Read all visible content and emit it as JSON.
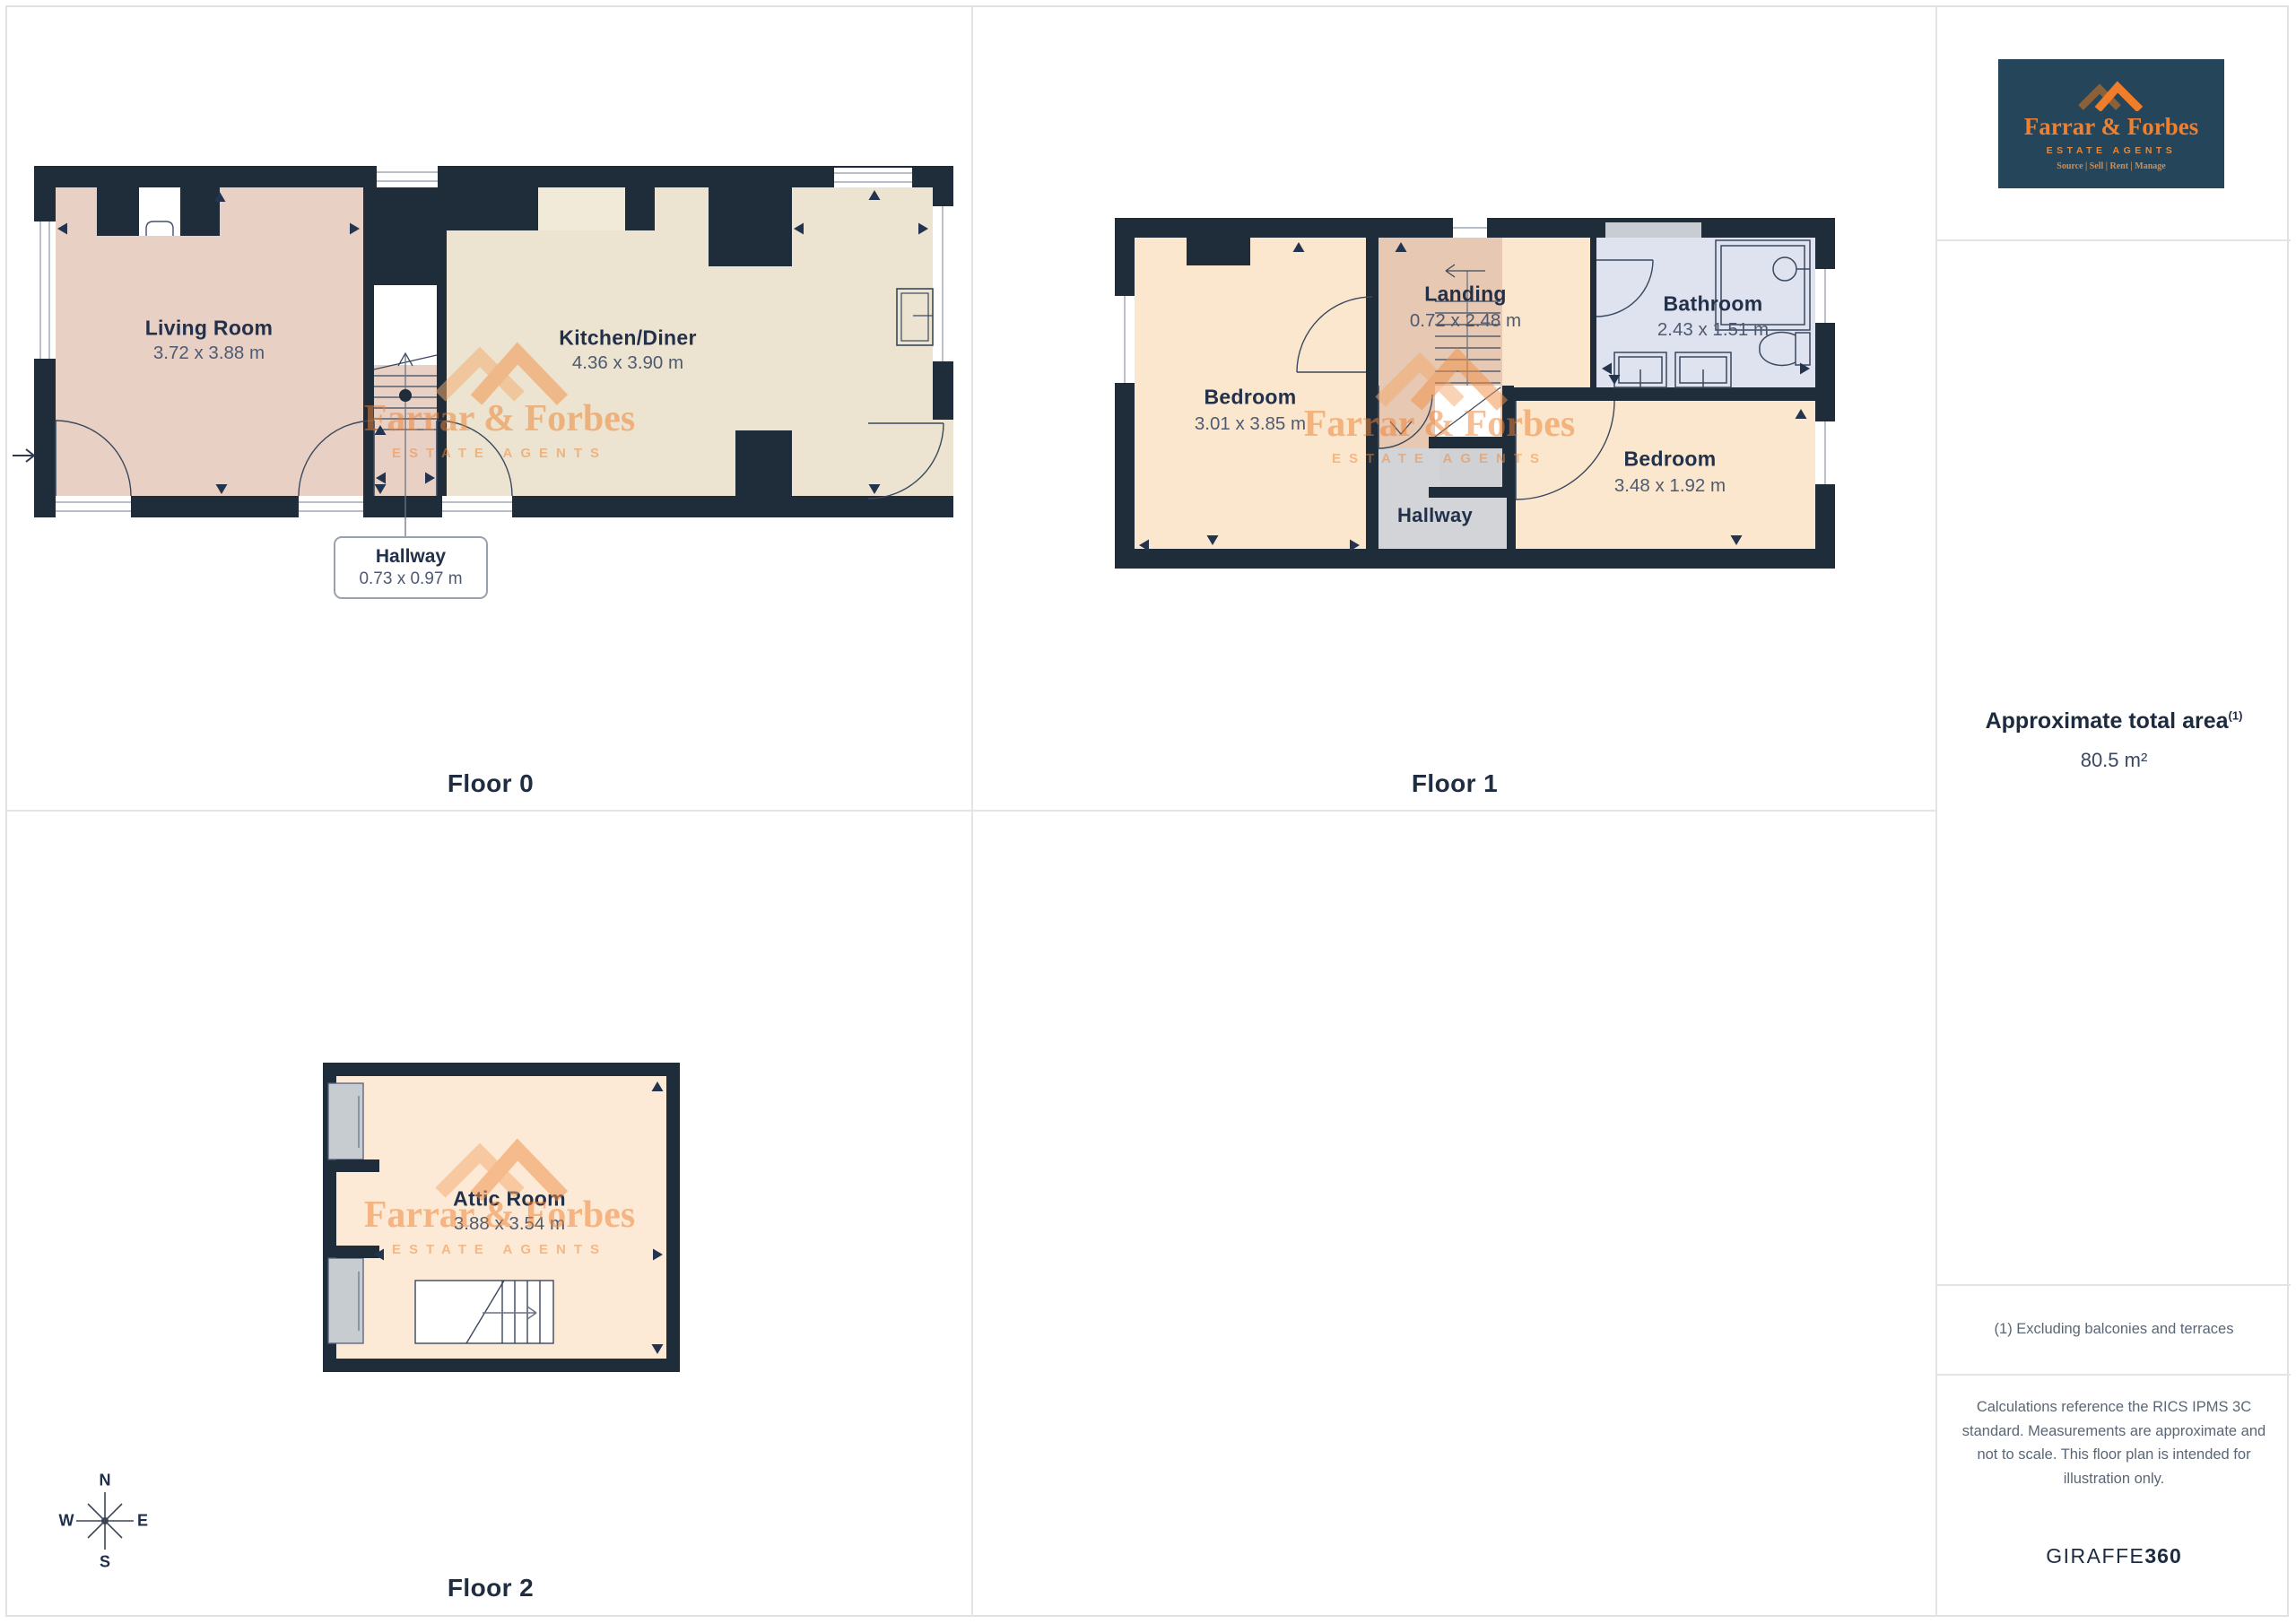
{
  "branding": {
    "logo": {
      "name": "Farrar & Forbes",
      "subtitle": "ESTATE AGENTS",
      "tagline": "Source | Sell | Rent | Manage"
    },
    "watermark": {
      "name": "Farrar & Forbes",
      "subtitle": "ESTATE AGENTS"
    }
  },
  "floors": [
    {
      "label": "Floor 0",
      "rooms": [
        {
          "name": "Living Room",
          "dims": "3.72 x 3.88 m"
        },
        {
          "name": "Kitchen/Diner",
          "dims": "4.36 x 3.90 m"
        },
        {
          "name": "Hallway",
          "dims": "0.73 x 0.97 m"
        }
      ]
    },
    {
      "label": "Floor 1",
      "rooms": [
        {
          "name": "Bedroom",
          "dims": "3.01 x 3.85 m"
        },
        {
          "name": "Landing",
          "dims": "0.72 x 2.48 m"
        },
        {
          "name": "Bathroom",
          "dims": "2.43 x 1.51 m"
        },
        {
          "name": "Bedroom",
          "dims": "3.48 x 1.92 m"
        },
        {
          "name": "Hallway",
          "dims": ""
        }
      ]
    },
    {
      "label": "Floor 2",
      "rooms": [
        {
          "name": "Attic Room",
          "dims": "3.88 x 3.54 m"
        }
      ]
    }
  ],
  "compass": {
    "n": "N",
    "e": "E",
    "s": "S",
    "w": "W"
  },
  "sidebar": {
    "area_heading": "Approximate total area",
    "area_note_ref": "(1)",
    "area_value": "80.5 m²",
    "footnote": "(1) Excluding balconies and terraces",
    "disclaimer": "Calculations reference the RICS IPMS 3C standard. Measurements are approximate and not to scale. This floor plan is intended for illustration only.",
    "brand_name": "GIRAFFE",
    "brand_suffix": "360"
  },
  "colors": {
    "wall": "#1f2c3a",
    "living_room": "#e9d0c5",
    "kitchen": "#ece4d0",
    "bedroom": "#fbe7cd",
    "landing": "#e7c8b2",
    "bathroom": "#dee3ef",
    "hallway_gray": "#d2d4d7",
    "attic": "#fcead6",
    "brand_orange": "#ee7d2b",
    "watermark_orange": "#f08b45",
    "logo_bg": "#24455a",
    "ink": "#223047"
  }
}
